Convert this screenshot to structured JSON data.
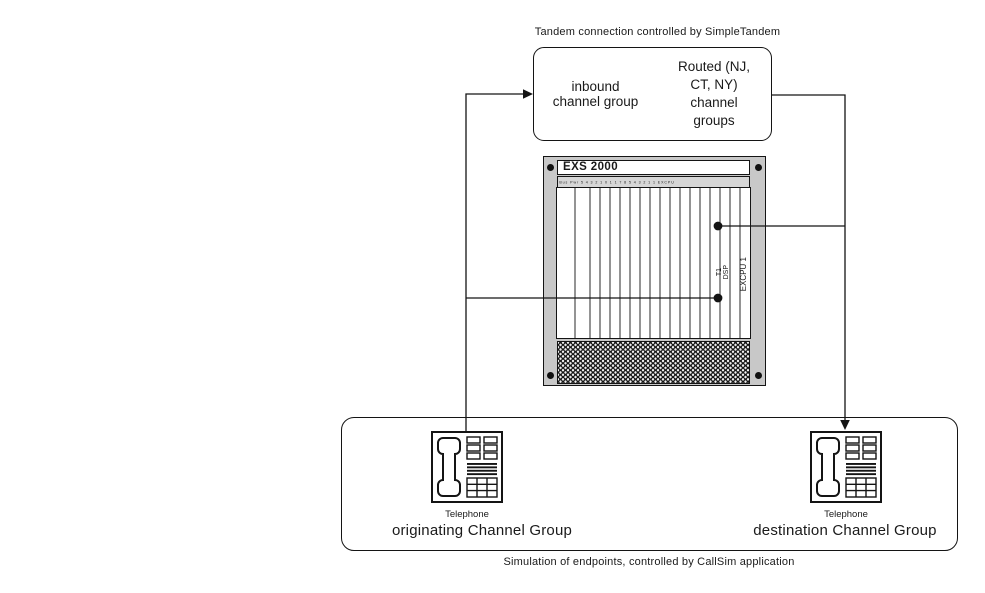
{
  "colors": {
    "background": "#ffffff",
    "line": "#141414",
    "chassis_frame": "#c8c8c8",
    "vent_dark": "#161616"
  },
  "top_caption": "Tandem connection controlled by SimpleTandem",
  "tandem_box": {
    "inbound": "inbound\nchannel group",
    "routed": "Routed (NJ,\nCT, NY)\nchannel\ngroups"
  },
  "chassis": {
    "title": "EXS 2000",
    "slot_labels": "Bus  Pwr   5  4  3  2  1  0  1  1  7  8  5  4  3  2  1  1  EXCPU",
    "cards": {
      "t1": "T1",
      "dsp": "DSP",
      "excpu": "EXCPU 1"
    }
  },
  "endpoints": {
    "left": {
      "device": "Telephone",
      "group": "originating Channel Group"
    },
    "right": {
      "device": "Telephone",
      "group": "destination Channel Group"
    },
    "caption": "Simulation of endpoints, controlled by CallSim application"
  }
}
